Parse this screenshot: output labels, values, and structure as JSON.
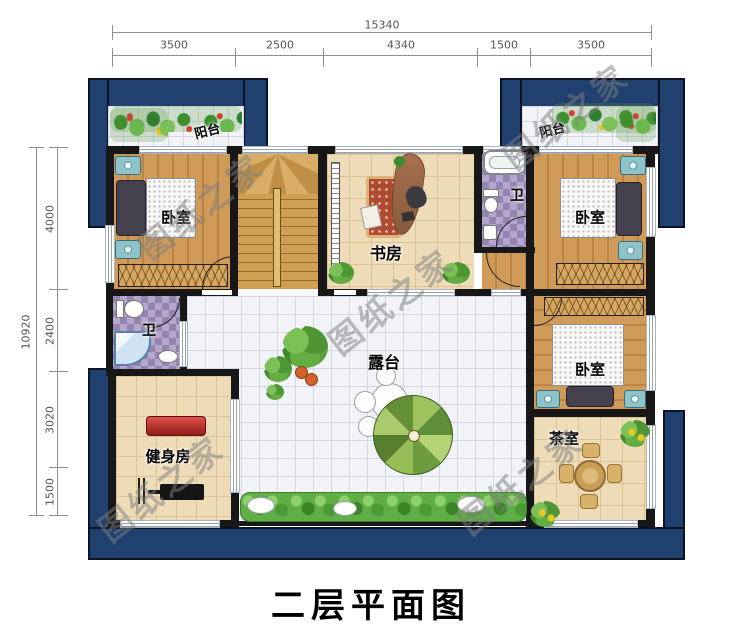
{
  "title": "二层平面图",
  "watermark": "图纸之家",
  "dimensions": {
    "top": {
      "total": "15340",
      "segments": [
        "3500",
        "2500",
        "4340",
        "1500",
        "3500"
      ]
    },
    "left": {
      "total": "10920",
      "segments": [
        "4000",
        "2400",
        "3020",
        "1500"
      ]
    }
  },
  "rooms": {
    "balcony_left": "阳台",
    "balcony_right": "阳台",
    "bedroom_top_left": "卧室",
    "bedroom_top_right": "卧室",
    "bedroom_mid_right": "卧室",
    "study": "书房",
    "bath_top": "卫",
    "bath_left": "卫",
    "terrace": "露台",
    "gym": "健身房",
    "tea_room": "茶室"
  },
  "colors": {
    "roof_navy": "#20406f",
    "wall_black": "#171717",
    "wood_floor": "#d09a58",
    "purple_tile": "#9385af",
    "terrace_tile": "#f2f3f7"
  }
}
